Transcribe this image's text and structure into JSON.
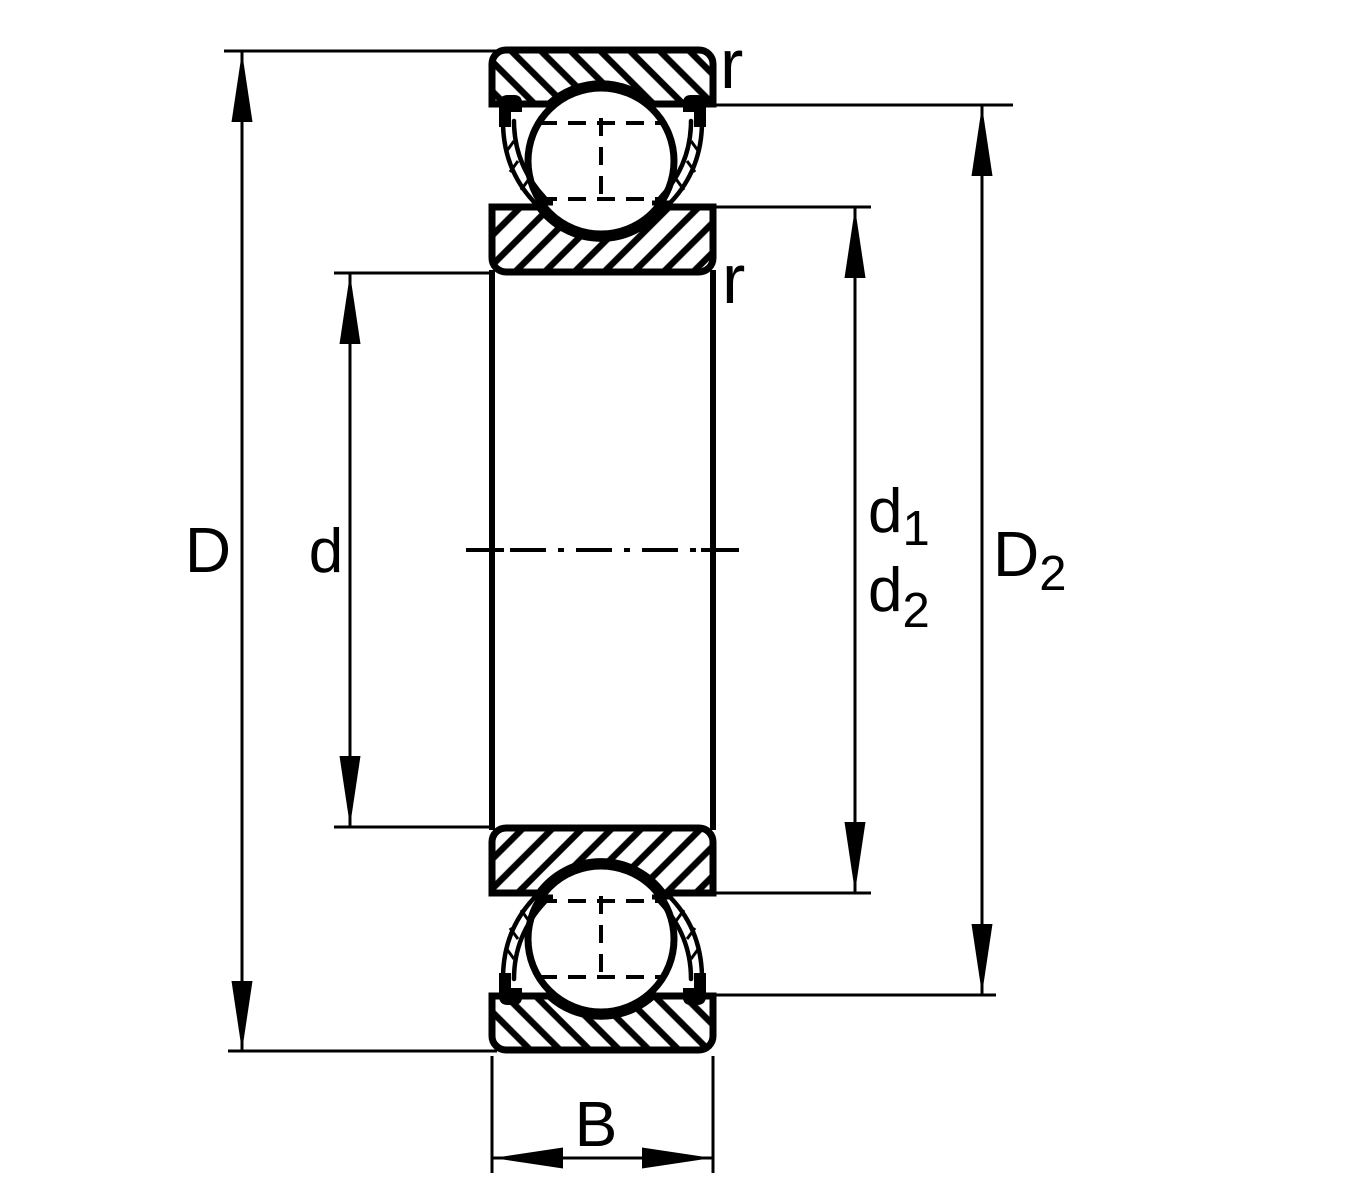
{
  "diagram": {
    "background_color": "#ffffff",
    "line_color": "#000000",
    "dimensions": {
      "D": {
        "label": "D"
      },
      "d": {
        "label": "d"
      },
      "d1": {
        "base": "d",
        "sub": "1"
      },
      "d2": {
        "base": "d",
        "sub": "2"
      },
      "D2": {
        "base": "D",
        "sub": "2"
      },
      "B": {
        "label": "B"
      },
      "r_outer": {
        "label": "r"
      },
      "r_inner": {
        "label": "r"
      }
    }
  }
}
